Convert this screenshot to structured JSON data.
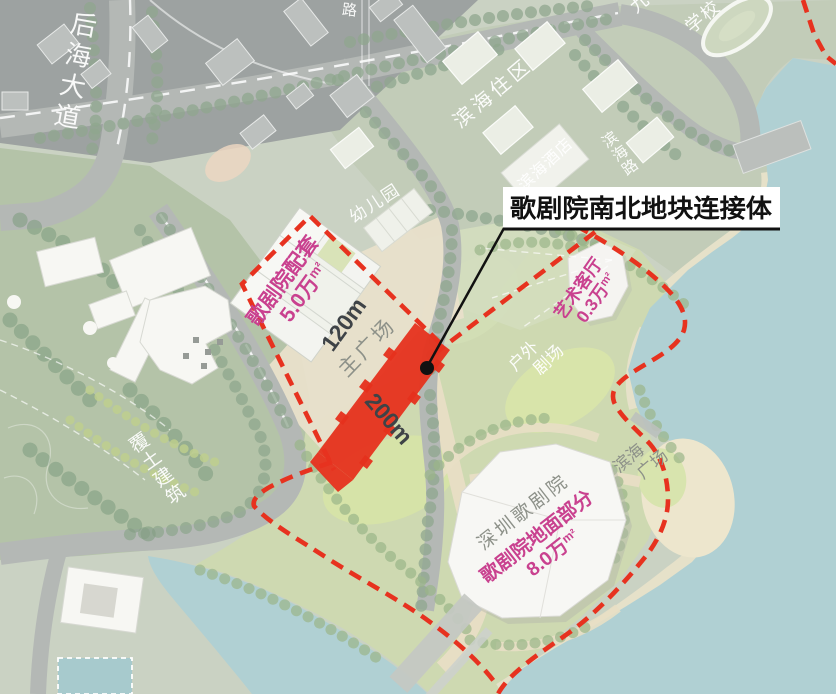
{
  "callout": {
    "label": "歌剧院南北地块连接体"
  },
  "road_labels": {
    "houhai_avenue": "后海大道",
    "partial_road": "路",
    "binhai_road": "滨海路"
  },
  "area_labels": {
    "binhai_residential": "滨海住区",
    "school_partial_1": "九",
    "school_partial_2": "学校",
    "binhai_hotel": "滨海酒店",
    "kindergarten": "幼儿园",
    "earth_sheltered_building": "覆土建筑",
    "outdoor_theater_line1": "户外",
    "outdoor_theater_line2": "剧场",
    "binhai_plaza_line1": "滨海",
    "binhai_plaza_line2": "广场",
    "main_plaza": "主广场",
    "shenzhen_opera_house": "深圳歌剧院"
  },
  "program_labels": {
    "opera_support": {
      "name": "歌剧院配套",
      "area": "5.0万",
      "unit": "m²"
    },
    "art_hall": {
      "name": "艺术客厅",
      "area": "0.3万",
      "unit": "m²"
    },
    "opera_ground": {
      "name": "歌剧院地面部分",
      "area": "8.0万",
      "unit": "m²"
    }
  },
  "dimensions": {
    "north_parcel_width": "120m",
    "connector_length": "200m"
  },
  "colors": {
    "boundary_red": "#e7321f",
    "connector_red": "#e6311d",
    "program_pink": "#c9418f",
    "dimension_gray": "#3e4347",
    "water_teal": "#a5c9cd",
    "callout_black": "#111111"
  }
}
